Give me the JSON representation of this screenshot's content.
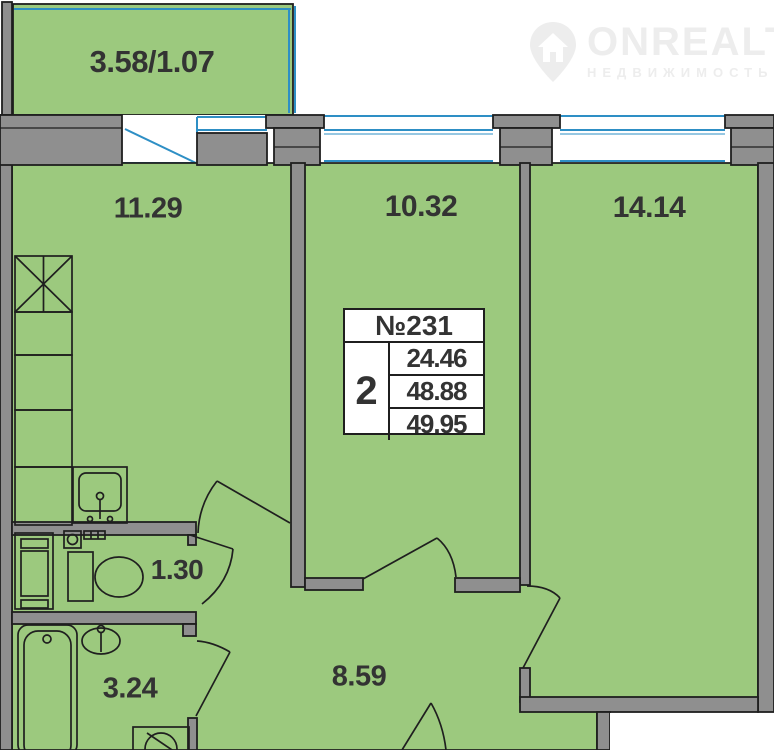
{
  "colors": {
    "background": "#ffffff",
    "room_fill": "#9cc97e",
    "wall": "#8f8f8f",
    "outline": "#1f1f1f",
    "window_blue": "#2e8fc5",
    "label_text": "#333333",
    "logo_gray": "#ededed"
  },
  "logo": {
    "brand": "ONREALT",
    "subtitle": "НЕДВИЖИМОСТЬ"
  },
  "unit_card": {
    "unit_number": "№231",
    "rooms_count": "2",
    "areas": [
      "24.46",
      "48.88",
      "49.95"
    ]
  },
  "rooms": {
    "balcony": "3.58/1.07",
    "kitchen_living": "11.29",
    "bedroom_small": "10.32",
    "bedroom_large": "14.14",
    "wc": "1.30",
    "bathroom": "3.24",
    "hallway": "8.59"
  }
}
